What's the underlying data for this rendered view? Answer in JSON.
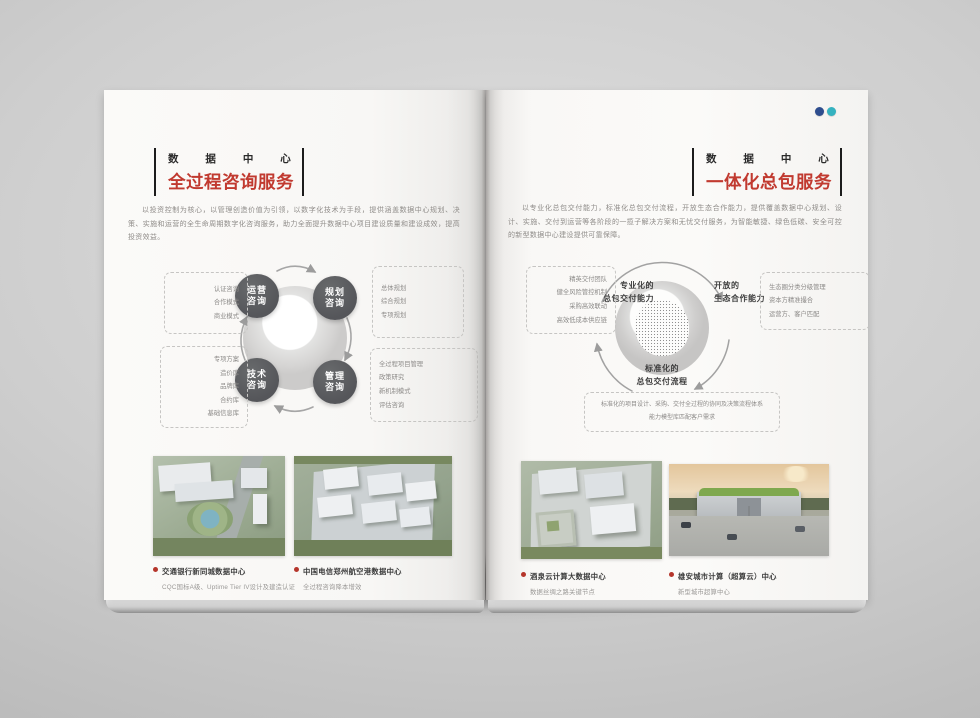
{
  "colors": {
    "accent_red": "#c13a30",
    "node_gray": "#57585a",
    "badge_blue": "#2e4d8e",
    "badge_teal": "#35b2c0"
  },
  "left_page": {
    "eyebrow": "数据中心",
    "title": "全过程咨询服务",
    "intro": "以投资控制为核心，以管理创造价值为引领，以数字化技术为手段，提供涵盖数据中心规划、决策、实施和运营的全生命周期数字化咨询服务，助力全面提升数据中心项目建设质量和建设成效，提高投资效益。",
    "diagram": {
      "nodes": [
        {
          "line1": "运营",
          "line2": "咨询"
        },
        {
          "line1": "规划",
          "line2": "咨询"
        },
        {
          "line1": "技术",
          "line2": "咨询"
        },
        {
          "line1": "管理",
          "line2": "咨询"
        }
      ],
      "boxes": {
        "top_left": {
          "items": [
            "认证咨询",
            "合作模式",
            "商业模式"
          ]
        },
        "top_right": {
          "items": [
            "总体规划",
            "综合规划",
            "专项规划"
          ]
        },
        "bottom_left": {
          "items": [
            "专项方案",
            "造价库",
            "品牌库",
            "合约库",
            "基础信息库"
          ]
        },
        "bottom_right": {
          "items": [
            "全过程项目管理",
            "政策研究",
            "新机制模式",
            "评估咨询"
          ]
        }
      }
    },
    "projects": [
      {
        "name": "交通银行新同城数据中心",
        "desc": "CQC国标A级、Uptime Tier IV设计及建造认证"
      },
      {
        "name": "中国电信郑州航空港数据中心",
        "desc": "全过程咨询降本增效"
      }
    ]
  },
  "right_page": {
    "eyebrow": "数据中心",
    "title": "一体化总包服务",
    "intro": "以专业化总包交付能力，标准化总包交付流程，开放生态合作能力，提供覆盖数据中心规划、设计、实施、交付到运营等各阶段的一揽子解决方案和无忧交付服务，为智能敏捷、绿色低碳、安全可控的新型数据中心建设提供可靠保障。",
    "diagram": {
      "labels": {
        "left": {
          "line1": "专业化的",
          "line2": "总包交付能力"
        },
        "right": {
          "line1": "开放的",
          "line2": "生态合作能力"
        },
        "bottom": {
          "line1": "标准化的",
          "line2": "总包交付流程"
        }
      },
      "boxes": {
        "left": {
          "items": [
            "精英交付团队",
            "健全风险管控机制",
            "采购高效联动",
            "高效低成本供应链"
          ]
        },
        "right": {
          "items": [
            "生态圈分类分级管理",
            "资本方精准撮合",
            "运营方、客户匹配"
          ]
        },
        "bottom": {
          "items": [
            "标准化的项目设计、采购、交付全过程的协同及决策流程体系",
            "能力模型库匹配客户需求"
          ]
        }
      }
    },
    "projects": [
      {
        "name": "酒泉云计算大数据中心",
        "desc": "数据丝绸之路关键节点"
      },
      {
        "name": "雄安城市计算（超算云）中心",
        "desc": "新型城市超算中心"
      }
    ]
  }
}
